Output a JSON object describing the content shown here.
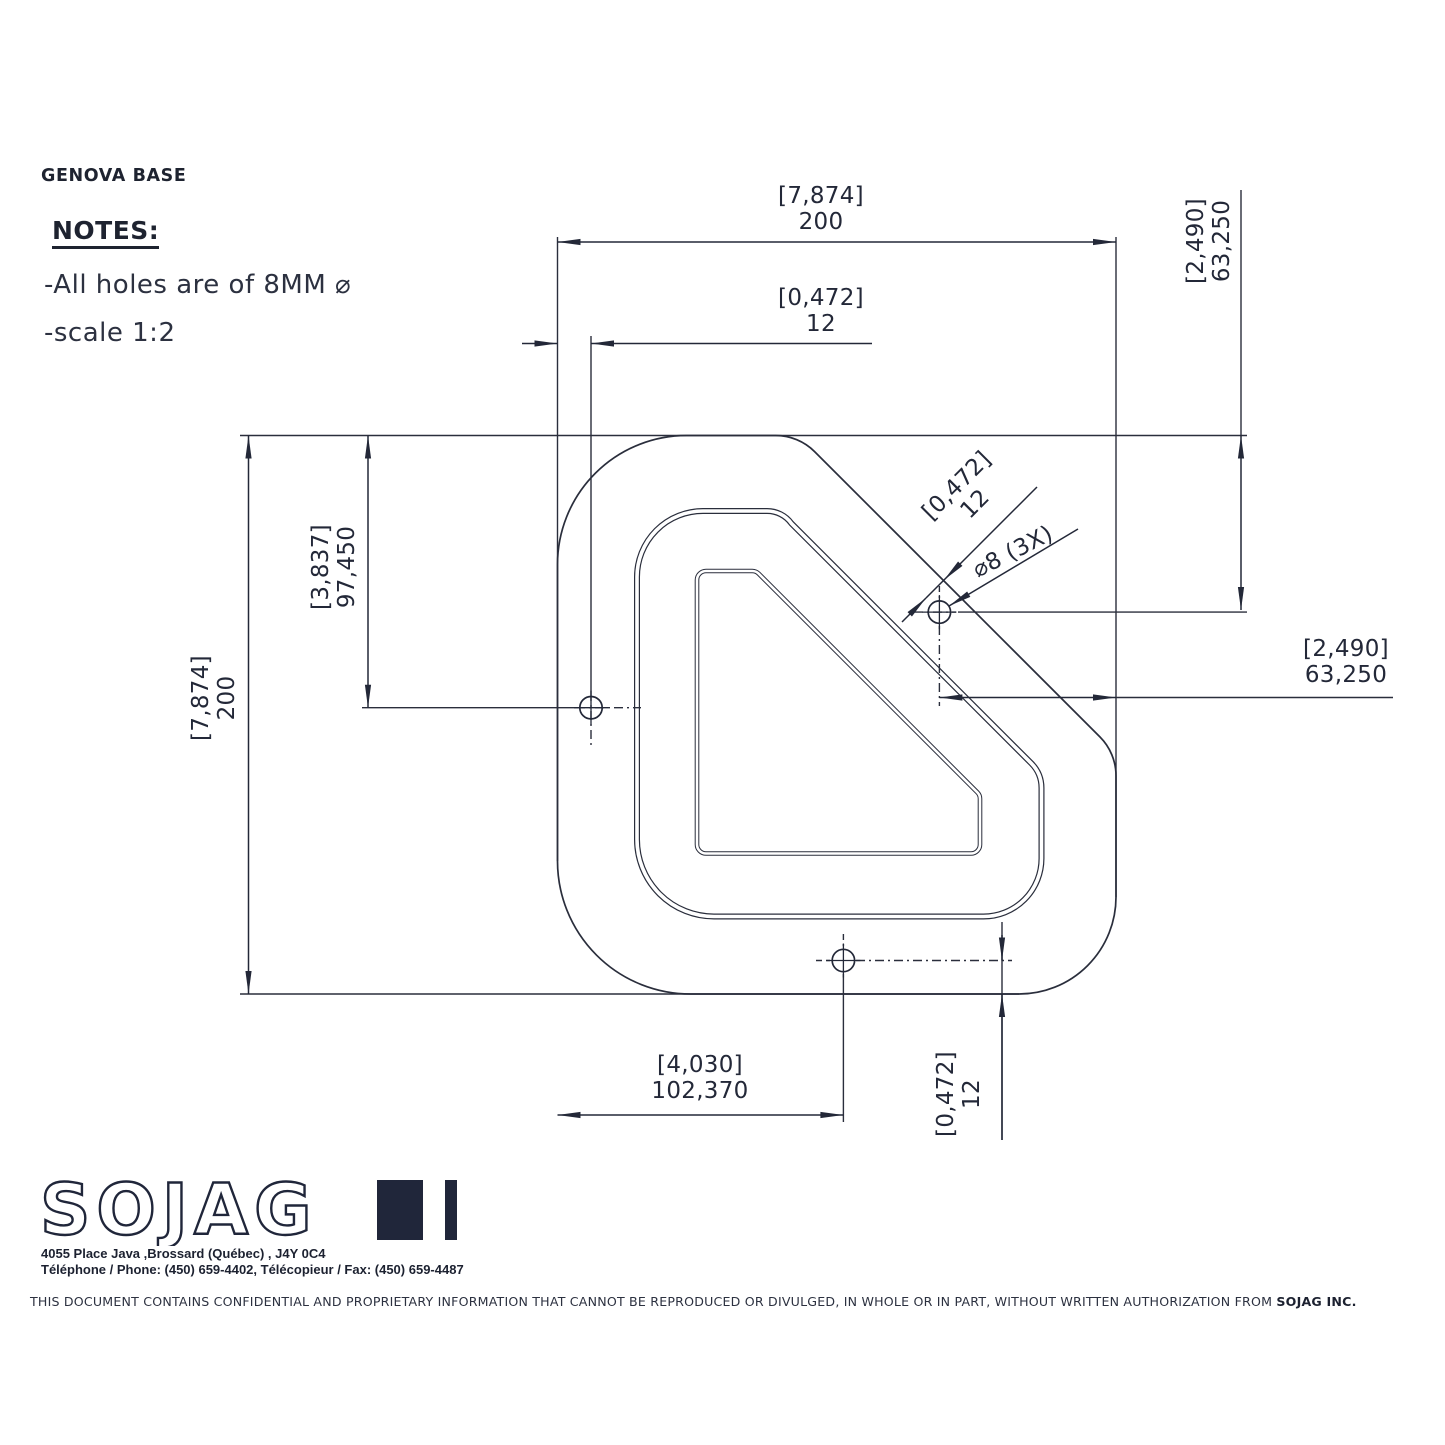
{
  "title": "GENOVA BASE",
  "notes": {
    "heading": "NOTES:",
    "item1": "-All holes are of 8MM ⌀",
    "item2": "-scale 1:2"
  },
  "dimensions": {
    "top_width": {
      "bracket": "[7,874]",
      "value": "200"
    },
    "top_offset": {
      "bracket": "[0,472]",
      "value": "12"
    },
    "right_top_vertical": {
      "bracket": "[2,490]",
      "value": "63,250"
    },
    "left_hole_vertical": {
      "bracket": "[3,837]",
      "value": "97,450"
    },
    "left_height": {
      "bracket": "[7,874]",
      "value": "200"
    },
    "diag_offset": {
      "bracket": "[0,472]",
      "value": "12"
    },
    "hole_callout": "⌀8 (3X)",
    "right_horizontal": {
      "bracket": "[2,490]",
      "value": "63,250"
    },
    "bottom_width": {
      "bracket": "[4,030]",
      "value": "102,370"
    },
    "bottom_offset": {
      "bracket": "[0,472]",
      "value": "12"
    }
  },
  "logo": {
    "text": "SOJAG",
    "address_line1": "4055 Place Java ,Brossard (Québec) , J4Y 0C4",
    "address_line2": "Téléphone / Phone: (450) 659-4402, Télécopieur / Fax: (450) 659-4487"
  },
  "footer": {
    "text_normal": "THIS DOCUMENT CONTAINS CONFIDENTIAL AND PROPRIETARY INFORMATION THAT CANNOT BE REPRODUCED OR DIVULGED, IN WHOLE OR IN PART, WITHOUT WRITTEN AUTHORIZATION FROM ",
    "text_bold": "SOJAG INC."
  },
  "colors": {
    "line": "#2a2e3c",
    "text": "#232838",
    "background": "#ffffff"
  }
}
